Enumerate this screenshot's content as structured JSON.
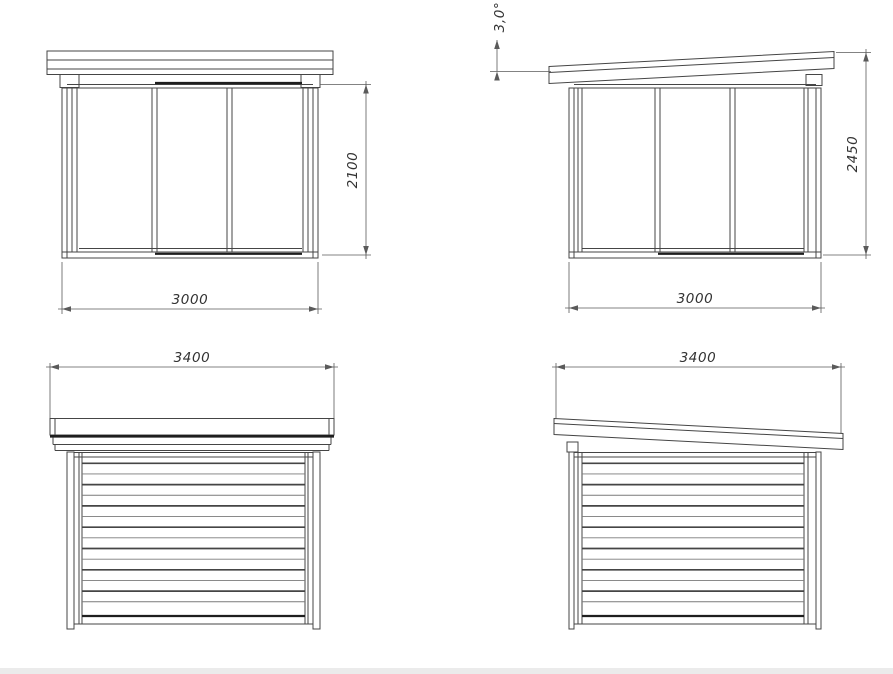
{
  "page": {
    "background": "#ffffff",
    "footer_bar_color": "#ebebeb"
  },
  "drawing": {
    "line_color": "#454545",
    "dim_color": "#5a5a5a",
    "accent_color": "#1e1e1e",
    "text_color": "#333333"
  },
  "views": {
    "front": {
      "width": "3000",
      "height": "2100"
    },
    "side_glazed": {
      "width": "3000",
      "height": "2450",
      "roof_angle": "3,0°"
    },
    "rear": {
      "roof_width": "3400"
    },
    "side_clad": {
      "roof_width": "3400"
    }
  }
}
